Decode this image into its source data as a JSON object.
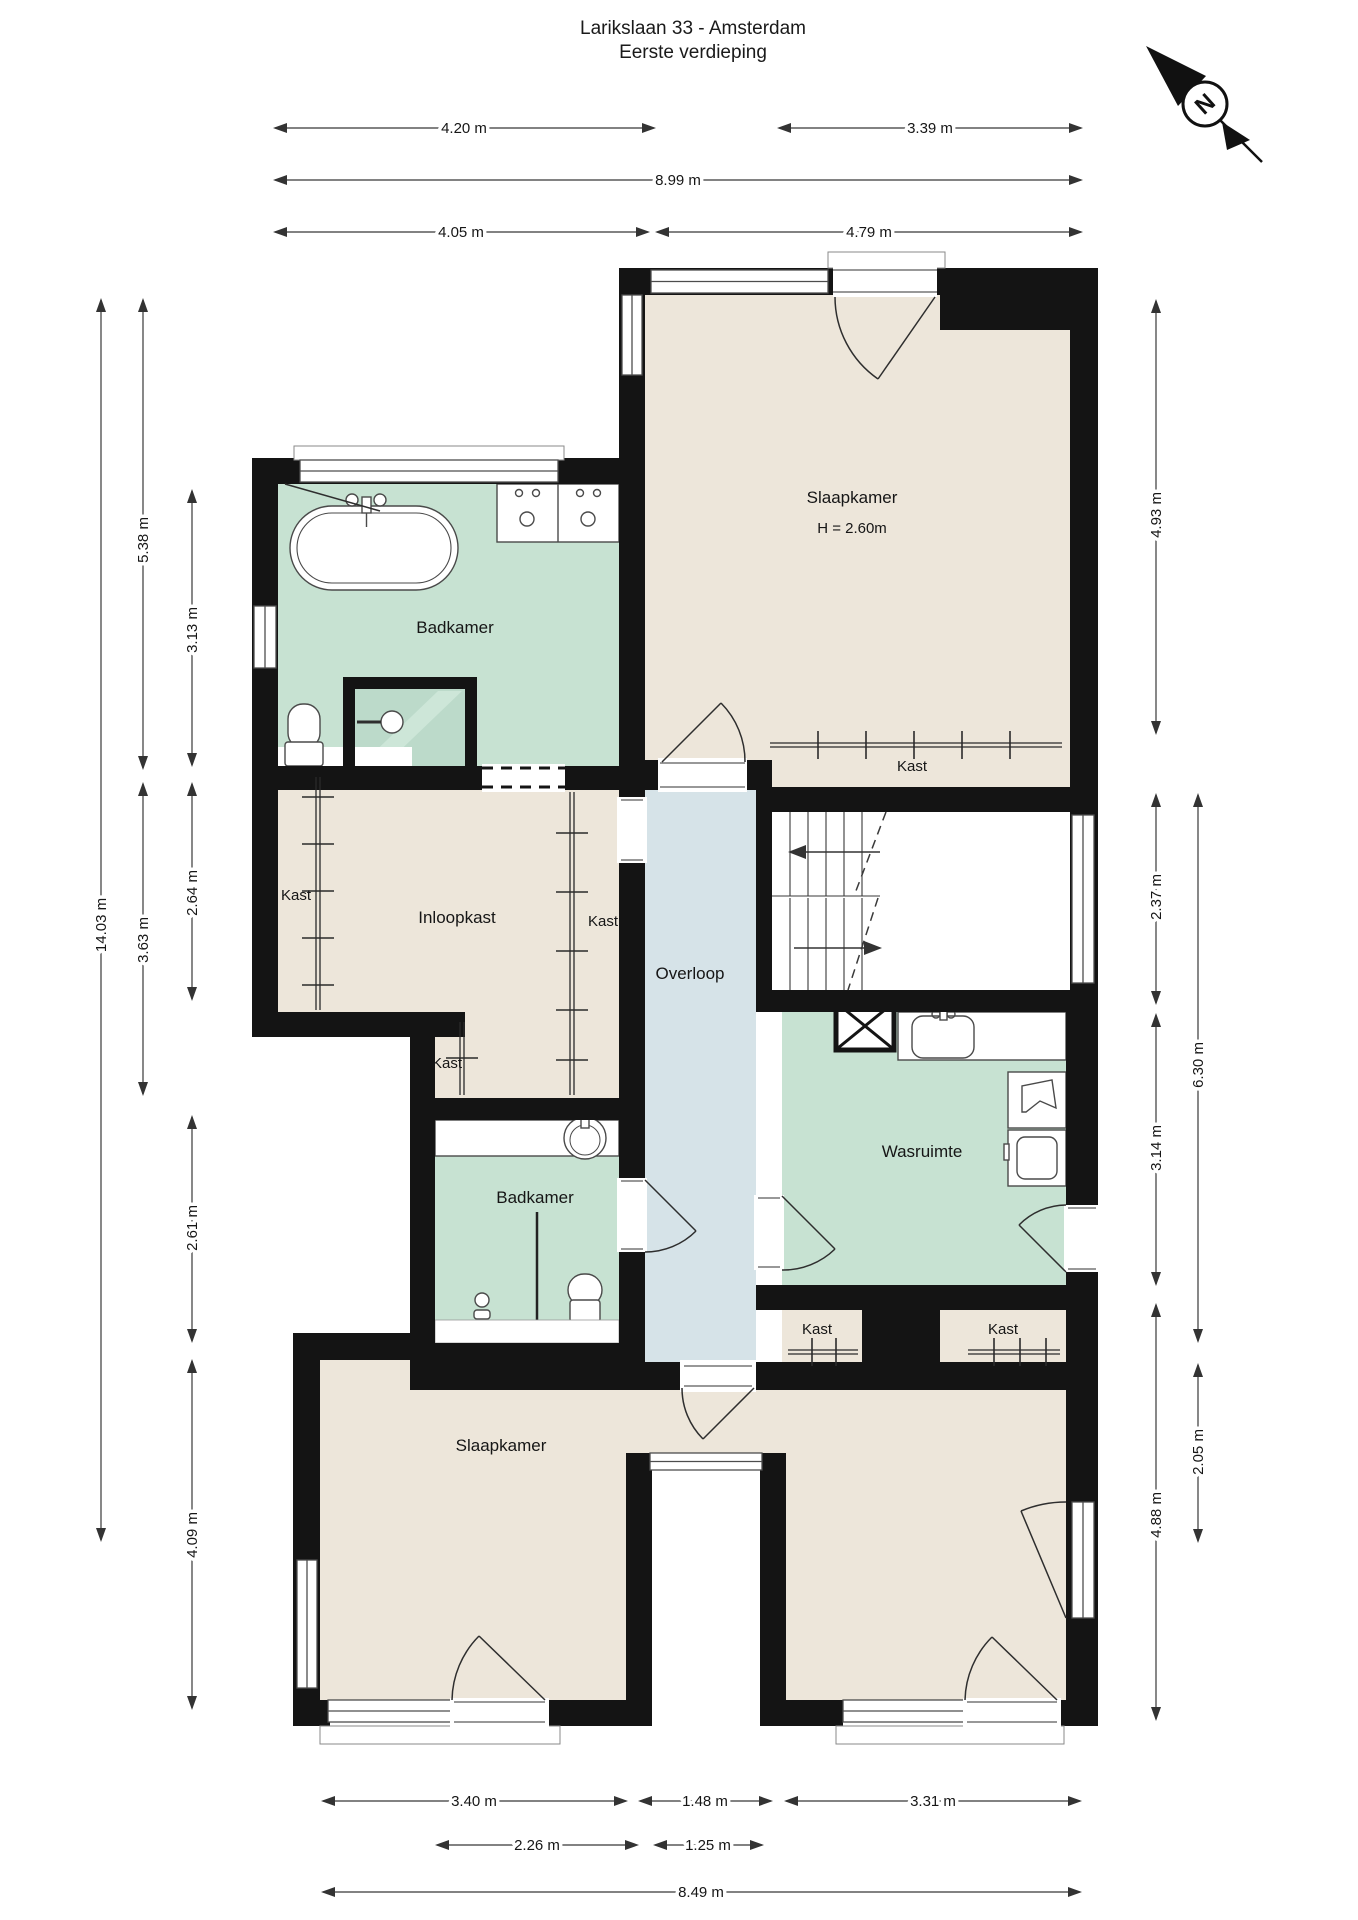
{
  "title": {
    "line1": "Larikslaan 33 - Amsterdam",
    "line2": "Eerste verdieping"
  },
  "compass": {
    "north_label": "N"
  },
  "colors": {
    "room_beige": "#EDE6DA",
    "room_green": "#C7E2D2",
    "room_blue": "#D6E3E8",
    "shower_green": "#B9D8C6",
    "wall_black": "#141414"
  },
  "rooms": {
    "badkamer_top": {
      "label": "Badkamer"
    },
    "slaapkamer_top": {
      "label": "Slaapkamer",
      "height": "H = 2.60m"
    },
    "kast_top": {
      "label": "Kast"
    },
    "kast_left": {
      "label": "Kast"
    },
    "inloopkast": {
      "label": "Inloopkast"
    },
    "kast_mid": {
      "label": "Kast"
    },
    "overloop": {
      "label": "Overloop"
    },
    "kast_small": {
      "label": "Kast"
    },
    "wasruimte": {
      "label": "Wasruimte"
    },
    "badkamer_bottom": {
      "label": "Badkamer"
    },
    "kast_bottom_left": {
      "label": "Kast"
    },
    "kast_bottom_right": {
      "label": "Kast"
    },
    "slaapkamer_bottom": {
      "label": "Slaapkamer"
    }
  },
  "dimensions": {
    "top": [
      {
        "label": "4.20 m"
      },
      {
        "label": "3.39 m"
      },
      {
        "label": "8.99 m"
      },
      {
        "label": "4.05 m"
      },
      {
        "label": "4.79 m"
      }
    ],
    "bottom": [
      {
        "label": "3.40 m"
      },
      {
        "label": "1.48 m"
      },
      {
        "label": "3.31 m"
      },
      {
        "label": "2.26 m"
      },
      {
        "label": "1.25 m"
      },
      {
        "label": "8.49 m"
      }
    ],
    "left": [
      {
        "label": "14.03 m"
      },
      {
        "label": "5.38 m"
      },
      {
        "label": "3.63 m"
      },
      {
        "label": "3.13 m"
      },
      {
        "label": "2.64 m"
      },
      {
        "label": "2.61 m"
      },
      {
        "label": "4.09 m"
      }
    ],
    "right": [
      {
        "label": "4.93 m"
      },
      {
        "label": "2.37 m"
      },
      {
        "label": "3.14 m"
      },
      {
        "label": "4.88 m"
      },
      {
        "label": "6.30 m"
      },
      {
        "label": "2.05 m"
      }
    ]
  }
}
